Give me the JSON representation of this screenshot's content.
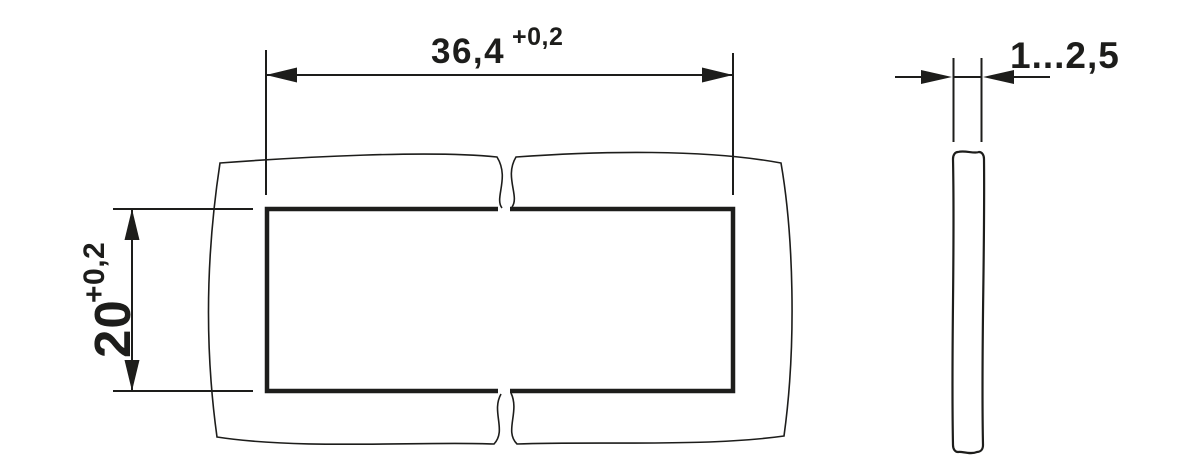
{
  "page": {
    "background_color": "#ffffff",
    "line_color": "#1d1d1b"
  },
  "front_view": {
    "description": "panel cutout front view with break lines",
    "width_dimension": {
      "value": "36,4",
      "tolerance": "+0,2"
    },
    "height_dimension": {
      "value": "20",
      "tolerance": "+0,2"
    }
  },
  "side_view": {
    "description": "panel thickness side profile",
    "thickness_dimension": {
      "value": "1...2,5"
    }
  }
}
